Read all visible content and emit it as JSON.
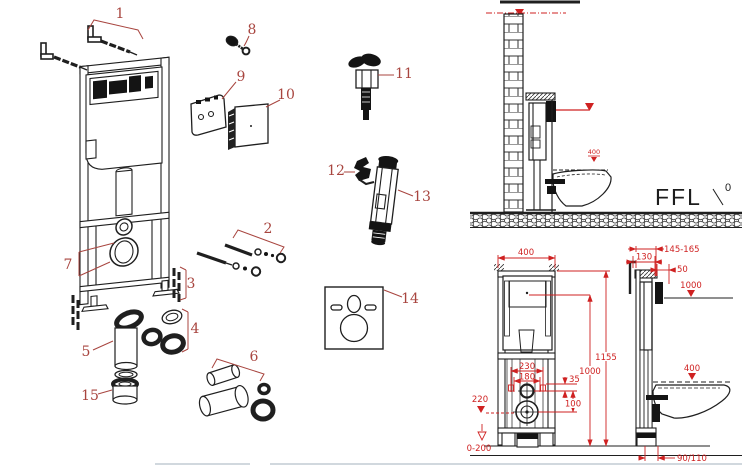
{
  "title": "Concealed cistern frame – exploded parts and installation dimensions",
  "colors": {
    "line": "#1f1f1f",
    "part_label": "#a8453f",
    "dimension": "#cf2121",
    "separator": "#c2ccd4",
    "background": "#ffffff"
  },
  "exploded_parts": {
    "labels": [
      "1",
      "2",
      "3",
      "4",
      "5",
      "6",
      "7",
      "8",
      "9",
      "10",
      "11",
      "12",
      "13",
      "14",
      "15"
    ]
  },
  "elevation_view": {
    "ffl_label": "FFL",
    "floor_level": "0",
    "seat_level": "400"
  },
  "front_view": {
    "width": "400",
    "total_height": "1155",
    "flush_pipe_height": "1000",
    "fixing_width_outer": "230",
    "fixing_width_inner": "180",
    "supply_offset": "35",
    "outlet_offset": "100",
    "outlet_height": "220",
    "foot_adjustment": "0-200"
  },
  "side_view": {
    "wall_thickness_range": "145-165",
    "frame_depth": "130",
    "panel_depth": "50",
    "button_level": "1000",
    "seat_height": "400",
    "outlet_pipe": "90/110"
  }
}
